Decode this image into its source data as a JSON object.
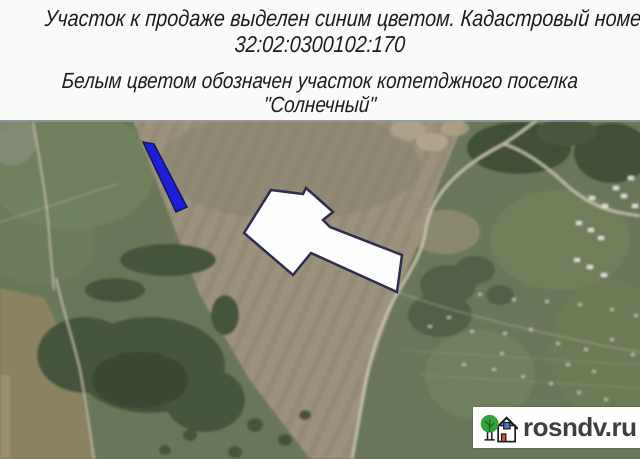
{
  "header": {
    "line1": "Участок к продаже выделен синим цветом. Кадастровый номер:",
    "line2": "32:02:0300102:170",
    "line3": "Белым цветом обозначен участок котетджного поселка",
    "line4": "\"Солнечный\""
  },
  "map": {
    "sale_plot": {
      "points": "143,22 154,24 187,87 176,92",
      "fill": "#1c1fd6",
      "stroke": "#14165e"
    },
    "village_plot": {
      "points": "271,70 303,74 306,68 314,75 333,92 323,100 330,107 402,135 397,172 311,133 293,155 244,113",
      "fill": "#fdfdfe",
      "stroke": "#2b2d52"
    }
  },
  "watermark": {
    "text": "rosndv.ru",
    "background": "#ffffff",
    "text_color": "#3e3e3e",
    "logo_tree_color": "#35a23c",
    "logo_window_color": "#4472c4",
    "logo_door_color": "#e04a33"
  },
  "colors": {
    "header_background": "#fafaf8",
    "header_text": "#1c1c1c",
    "map_base_green": "#697758",
    "plowed_field_tan": "#9d937d",
    "forest_dark_green": "#3f4f36",
    "road_light": "#cdc6b4"
  }
}
